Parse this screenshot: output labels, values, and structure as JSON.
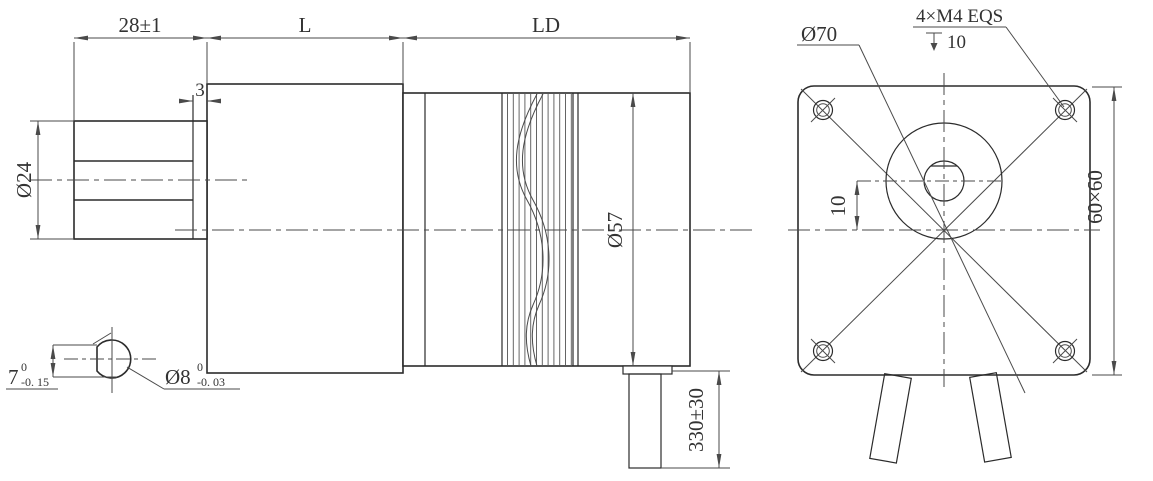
{
  "colors": {
    "background": "#ffffff",
    "object_line": "#2b2b2b",
    "dim_line": "#4a4a4a",
    "text": "#333333"
  },
  "side_view": {
    "dim_shaft_length": "28±1",
    "dim_gearbox_length": "L",
    "dim_motor_length": "LD",
    "dim_pilot_step": "3",
    "dim_boss_diameter": "Ø24",
    "dim_motor_diameter": "Ø57",
    "dim_cable_length": "330±30"
  },
  "shaft_section": {
    "across_flat": {
      "value": "7",
      "tol_upper": "0",
      "tol_lower": "-0. 15"
    },
    "diameter": {
      "value": "Ø8",
      "tol_upper": "0",
      "tol_lower": "-0. 03"
    }
  },
  "front_view": {
    "dim_bolt_circle": "Ø70",
    "mount_holes": "4×M4 EQS",
    "hole_depth": "10",
    "dim_shaft_offset": "10",
    "dim_frame_size": "60×60"
  }
}
